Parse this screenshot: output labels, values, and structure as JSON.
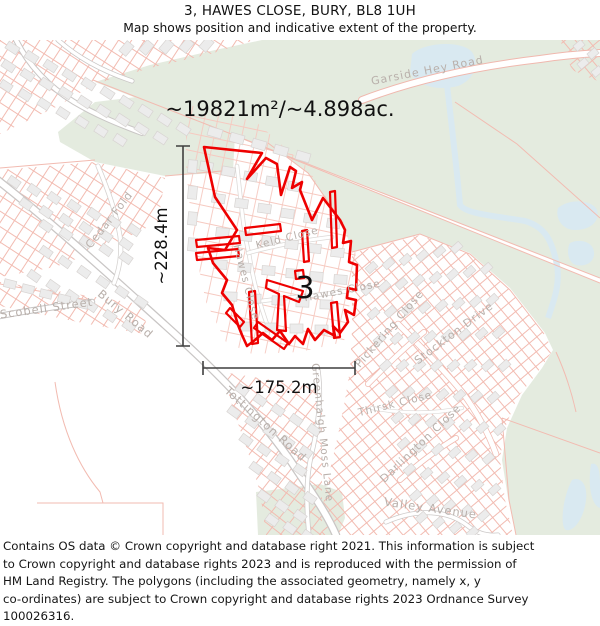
{
  "header": {
    "title": "3, HAWES CLOSE, BURY, BL8 1UH",
    "subtitle": "Map shows position and indicative extent of the property."
  },
  "map": {
    "area_label": "~19821m²/~4.898ac.",
    "height_label": "~228.4m",
    "width_label": "~175.2m",
    "plot_number": "3",
    "streets": {
      "garside_hey_road": "Garside Hey Road",
      "cedar_fold": "Cedar Fold",
      "scobell_street": "Scobell Street",
      "bury_road": "Bury Road",
      "tottington_road": "Tottington Road",
      "keld_close": "Keld Close",
      "hawes_close_vertical": "Hawes Close",
      "hawes_close_diagonal": "Hawes Close",
      "pickering_close": "Pickering Close",
      "stockton_drive": "Stockton Drive",
      "greenhalgh_moss_lane": "Greenhalgh Moss Lane",
      "thirsk_close": "Thirsk Close",
      "darlington_close": "Darlington Close",
      "valley_avenue": "Valley Avenue"
    }
  },
  "colors": {
    "property_outline": "#ee0000",
    "greenspace": "#e4ebdf",
    "water": "#d9e9f1",
    "road_casing": "#c9c6c5",
    "plot_line": "#f2bbb1",
    "building_fill": "#ececec",
    "street_label": "#b9b0ab",
    "dimension_line": "#3f3f3f"
  },
  "footer": {
    "lines": [
      "Contains OS data © Crown copyright and database right 2021. This information is subject",
      "to Crown copyright and database rights 2023 and is reproduced with the permission of",
      "HM Land Registry. The polygons (including the associated geometry, namely x, y",
      "co-ordinates) are subject to Crown copyright and database rights 2023 Ordnance Survey",
      "100026316."
    ]
  }
}
